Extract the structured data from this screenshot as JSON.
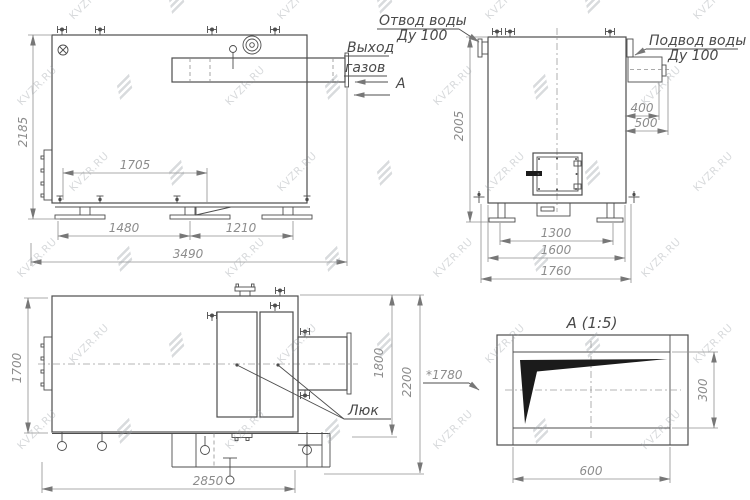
{
  "watermark": {
    "text": "KVZR.RU"
  },
  "front_view": {
    "dim_height": "2185",
    "dim_top": "1705",
    "dim_left": "1480",
    "dim_right": "1210",
    "dim_total": "3490",
    "gas_outlet_label_1": "Выход",
    "gas_outlet_label_2": "газов",
    "section_letter": "А"
  },
  "side_view": {
    "water_outlet_label_1": "Отвод воды",
    "water_outlet_label_2": "Ду 100",
    "water_inlet_label_1": "Подвод воды",
    "water_inlet_label_2": "Ду 100",
    "dim_height": "2005",
    "dim_400": "400",
    "dim_500": "500",
    "dim_1300": "1300",
    "dim_1600": "1600",
    "dim_1760": "1760"
  },
  "top_view": {
    "dim_1700": "1700",
    "dim_1800": "1800",
    "dim_2200": "2200",
    "dim_2850": "2850",
    "hatch_label": "Люк"
  },
  "detail_view": {
    "title": "А (1:5)",
    "dim_1780": "*1780",
    "dim_300": "300",
    "dim_600": "600"
  }
}
